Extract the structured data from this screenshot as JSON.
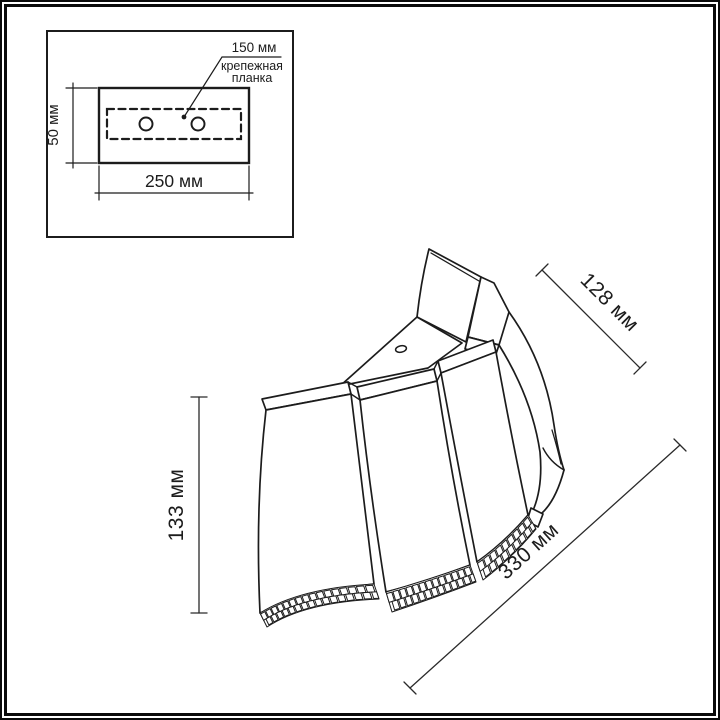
{
  "drawing": {
    "type": "technical-dimension-diagram",
    "subject": "wall-sconce-lamp-wireframe"
  },
  "inset": {
    "hole_spacing_label": "150 мм",
    "bracket_note_line1": "крепежная",
    "bracket_note_line2": "планка",
    "plate_height_label": "50 мм",
    "plate_width_label": "250 мм"
  },
  "dimensions": {
    "top_depth_label": "128 мм",
    "left_height_label": "133 мм",
    "bottom_width_label": "330 мм"
  },
  "colors": {
    "line": "#1c1c1c",
    "background": "#ffffff",
    "frame": "#0a0a0a"
  }
}
